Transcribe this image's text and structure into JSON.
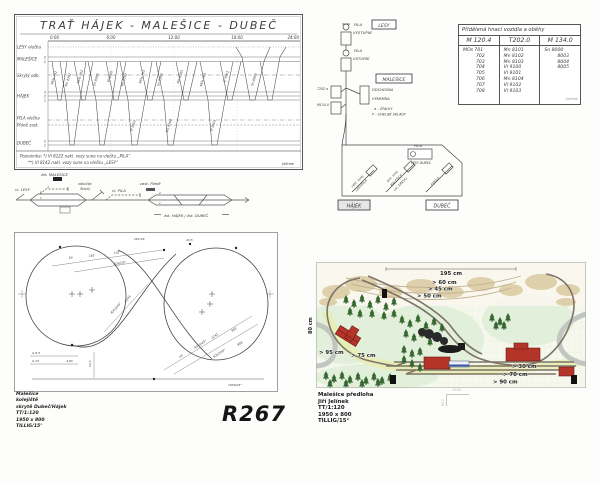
{
  "timetable": {
    "title": "TRAŤ  HÁJEK - MALEŠICE - DUBEČ",
    "times": [
      "0:00",
      "6:00",
      "12:00",
      "18:00",
      "24:00"
    ],
    "rows": {
      "lesy": "LESY vlečka",
      "malesice": "MALEŠICE",
      "skryty": "Skrytý odb.",
      "hajek": "HÁJEK",
      "pila": "PILA vlečka",
      "plane": "Pláně zast.",
      "dubec": "DUBEČ"
    },
    "tracks": {
      "malesice": [
        "2",
        "1"
      ],
      "hajek": [
        "3",
        "2",
        "1"
      ],
      "dubec": [
        "2",
        "1"
      ]
    },
    "trains": [
      "MOs 701",
      "Mn 8101",
      "MOs 702",
      "Sn 8000",
      "Vl 9100",
      "Mn 8102",
      "MOs 703",
      "Sn 8003",
      "Mn 8103",
      "MOs 704",
      "Vl 9101",
      "Sn 8004",
      "Vl 9102",
      "Mn 8104",
      "Vl 9103"
    ],
    "footnote_1": "Poznámka: *) Vl 8122 nakl. vozy sune na vlečku „PILA“",
    "footnote_2": "**) Vl 8142 nakl. vozy sune na vlečku „LESY“"
  },
  "schematic": {
    "vl_lesy": "vl. LESY",
    "zst_malesice": "žst. MALEŠICE",
    "odbocka_1": "odbočka",
    "odbocka_2": "Skrytý",
    "vl_pila": "vl. PILA",
    "zast_plane": "zast. Pláně",
    "zst_right": "žst. HÁJEK / žst. DUBEČ",
    "left_nums": [
      "4",
      "2",
      "1"
    ],
    "right_nums": [
      "2",
      "1"
    ]
  },
  "circulation": {
    "table": {
      "title": "Přidělená hnací vozidla a oběhy",
      "columns": [
        "M 120.4",
        "T202.0",
        "M 134.0"
      ],
      "col1": [
        "MOs 701",
        "702",
        "703",
        "704",
        "705",
        "706",
        "707",
        "708"
      ],
      "col2": [
        "Mn 8101",
        "Mn 8102",
        "Mn 8103",
        "Vl 9100",
        "Vl 9101",
        "Mn 8104",
        "Vl 9102",
        "Vl 9103"
      ],
      "col3": [
        "Sn 8000",
        "8003",
        "8004",
        "8005"
      ]
    },
    "labels": {
      "lesy": "LESY",
      "pila1a": "PILA",
      "pila1b": "VÝSTUPNÍ",
      "pila2a": "PILA",
      "pila2b": "VSTUPNÍ",
      "t202": "T202 a",
      "m134": "M134.0",
      "malesice": "MALEŠICE",
      "odchovna": "ODCHOVNA",
      "vykrmna": "VÝKRMNA",
      "legend_a": "a – ŠPALKY",
      "legend_p": "P – UHELNÉ SKLADY",
      "loop_pila": "PILA",
      "loop_lesy_dubec": "LESY DUBEČ",
      "siding1a": "odst. kolej",
      "siding1b": "LESY/PILA",
      "siding2a": "pov. vozy",
      "siding2b": "MALEŠICE",
      "siding2c": "ukl. DŘEVO",
      "siding3": "FIDDLE",
      "hajek": "HÁJEK",
      "dubec": "DUBEČ"
    }
  },
  "plan": {
    "big_label": "R267",
    "info": [
      "Malešice",
      "kolejiště",
      "skrytě Dubeč/Hájek",
      "TT/1:120",
      "1950 x 800",
      "TILLIG/15°"
    ],
    "dims": [
      "262,46",
      "43,5",
      "83",
      "183",
      "102",
      "R267/8°",
      "R353/45°",
      "1245",
      "43",
      "R310/45°",
      "1242",
      "R267/30°",
      "983",
      "966",
      "G 6,5",
      "G 13",
      "4,63",
      "14,5",
      "1950/45°"
    ]
  },
  "color_plan": {
    "meas": [
      "195 cm",
      "> 60 cm",
      "> 45 cm",
      "> 50 cm",
      "80 cm",
      "> 95 cm",
      "> 75 cm",
      "> 30 cm",
      "> 70 cm",
      "> 90 cm"
    ],
    "info": [
      "Malešice předloha",
      "Jiří Jelínek",
      "TT/1:120",
      "1950 x 800",
      "TILLIG/15°"
    ],
    "sketch_w": "1950",
    "sketch_h": "800"
  },
  "signature": "Jelínek",
  "colors": {
    "ink": "#3d3d3d",
    "building_red": "#b5342a",
    "tree_green": "#35662f",
    "hill_tan": "#d8c79a",
    "road_gray": "#c2c6c1",
    "track_gray": "#7d7467",
    "plan_bg": "#f6f8ee"
  }
}
